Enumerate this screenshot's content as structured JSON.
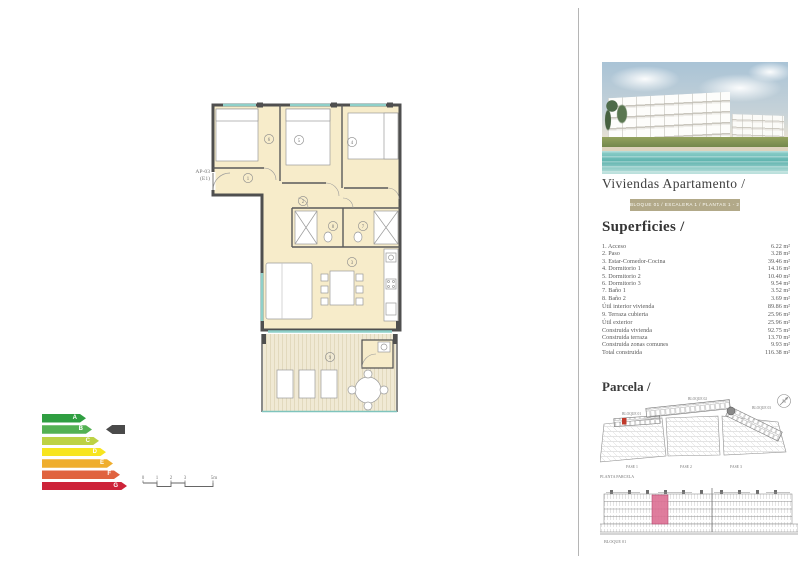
{
  "plan": {
    "unit_label": "AP-03",
    "unit_sublabel": "(E1)",
    "room_numbers": [
      "1",
      "2",
      "3",
      "4",
      "5",
      "6",
      "7",
      "8",
      "9"
    ]
  },
  "energy_chart": {
    "grades": [
      {
        "letter": "A",
        "color": "#2f9e41"
      },
      {
        "letter": "B",
        "color": "#53b153"
      },
      {
        "letter": "C",
        "color": "#bdd245"
      },
      {
        "letter": "D",
        "color": "#f7e51f"
      },
      {
        "letter": "E",
        "color": "#efae2e"
      },
      {
        "letter": "F",
        "color": "#e0633f"
      },
      {
        "letter": "G",
        "color": "#cd2339"
      }
    ],
    "selected_grade": "B",
    "pointer_color": "#4a4a4a"
  },
  "scale_bar": {
    "ticks": [
      "0",
      "1",
      "2",
      "3",
      "5m"
    ]
  },
  "panel": {
    "title": "Viviendas Apartamento /",
    "badge": "BLOQUE 01 / ESCALERA 1 / PLANTAS 1 - 2 - 3",
    "badge_color": "#b2a989",
    "superficies": {
      "title": "Superficies /",
      "rows": [
        {
          "label": "1. Acceso",
          "value": "6.22 m²"
        },
        {
          "label": "2. Paso",
          "value": "3.28 m²"
        },
        {
          "label": "3. Estar-Comedor-Cocina",
          "value": "39.46 m²"
        },
        {
          "label": "4. Dormitorio 1",
          "value": "14.16 m²"
        },
        {
          "label": "5. Dormitorio 2",
          "value": "10.40 m²"
        },
        {
          "label": "6. Dormitorio 3",
          "value": "9.54 m²"
        },
        {
          "label": "7. Baño 1",
          "value": "3.52 m²"
        },
        {
          "label": "8. Baño 2",
          "value": "3.69 m²"
        },
        {
          "label": "Útil interior vivienda",
          "value": "89.86 m²"
        },
        {
          "label": "9. Terraza cubierta",
          "value": "25.96 m²"
        },
        {
          "label": "Útil exterior",
          "value": "25.96 m²"
        },
        {
          "label": "Construida vivienda",
          "value": "92.75 m²"
        },
        {
          "label": "Construida terraza",
          "value": "13.70 m²"
        },
        {
          "label": "Construida zonas comunes",
          "value": "9.93 m²"
        },
        {
          "label": "Total construida",
          "value": "116.38 m²"
        }
      ]
    },
    "parcela": {
      "title": "Parcela /",
      "bloque1": "BLOQUE 01",
      "bloque2": "BLOQUE 02",
      "bloque3": "BLOQUE 03",
      "fase1": "FASE 1",
      "fase2": "FASE 2",
      "fase3": "FASE 3",
      "caption": "PLANTA PARCELA",
      "north": "N",
      "highlight_color": "#c0392b"
    },
    "elevation": {
      "caption": "BLOQUE 01",
      "highlight_color": "#db6f92"
    }
  }
}
